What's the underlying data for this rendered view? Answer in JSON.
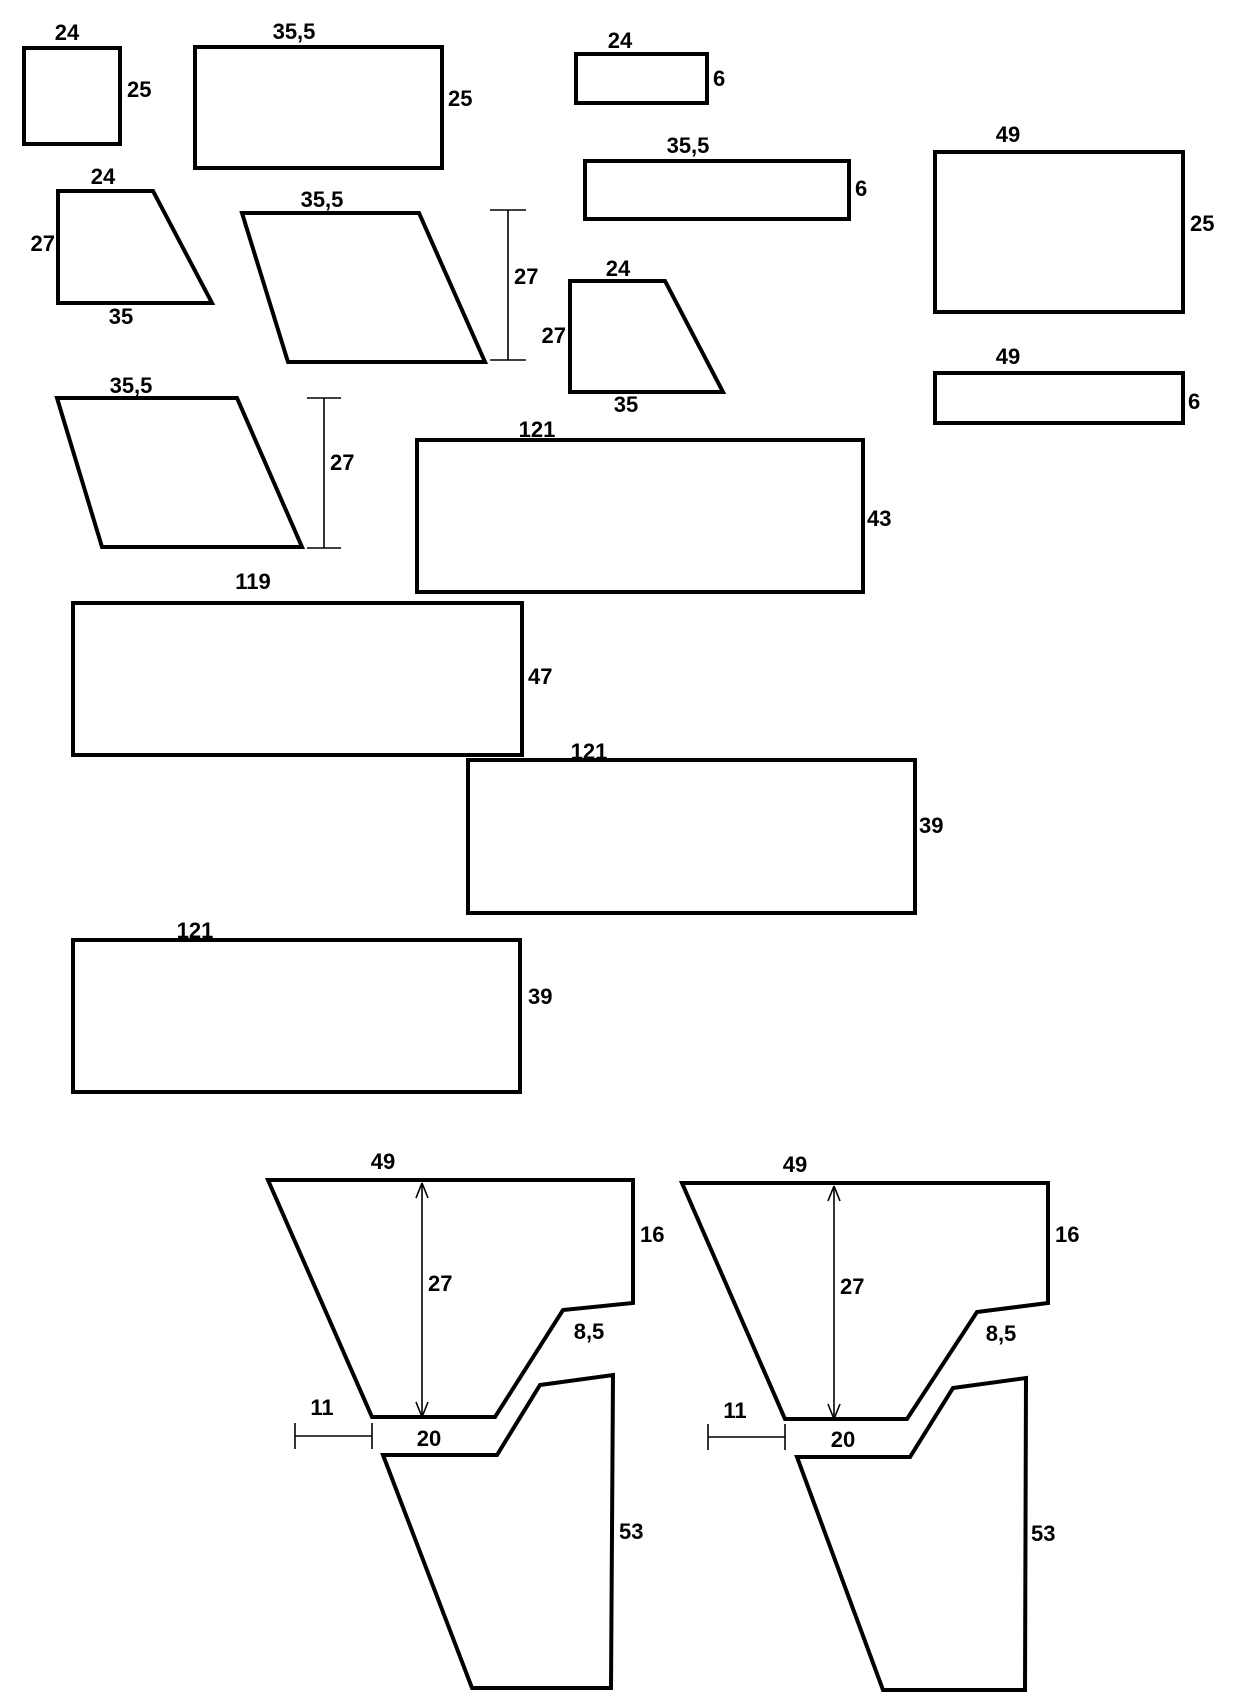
{
  "title": "sewing-pattern-pieces-dimensioned-drawing",
  "colors": {
    "background": "#ffffff",
    "line": "#000000"
  },
  "pieces": {
    "square_small": {
      "top": "24",
      "right": "25"
    },
    "rect_35_25": {
      "top": "35,5",
      "right": "25"
    },
    "rect_24_6": {
      "top": "24",
      "right": "6"
    },
    "rect_35_6": {
      "top": "35,5",
      "right": "6"
    },
    "rect_49_25": {
      "top": "49",
      "right": "25"
    },
    "rect_49_6": {
      "top": "49",
      "right": "6"
    },
    "trapezoid_top": {
      "top": "24",
      "left": "27",
      "bottom": "35"
    },
    "parallelogram_top": {
      "top": "35,5",
      "height_dim": "27"
    },
    "trapezoid_mid": {
      "top": "24",
      "left": "27",
      "bottom": "35"
    },
    "parallelogram_mid": {
      "top": "35,5",
      "height_dim": "27"
    },
    "rect_121_43": {
      "top": "121",
      "right": "43"
    },
    "rect_119_47": {
      "top": "119",
      "right": "47"
    },
    "rect_121_39_a": {
      "top": "121",
      "right": "39"
    },
    "rect_121_39_b": {
      "top": "121",
      "right": "39"
    },
    "panel_a_upper": {
      "top": "49",
      "right": "16",
      "height_dim": "27",
      "notch": "8,5",
      "offset": "11",
      "bottom": "20"
    },
    "panel_a_lower": {
      "right": "53"
    },
    "panel_b_upper": {
      "top": "49",
      "right": "16",
      "height_dim": "27",
      "notch": "8,5",
      "offset": "11",
      "bottom": "20"
    },
    "panel_b_lower": {
      "right": "53"
    }
  }
}
